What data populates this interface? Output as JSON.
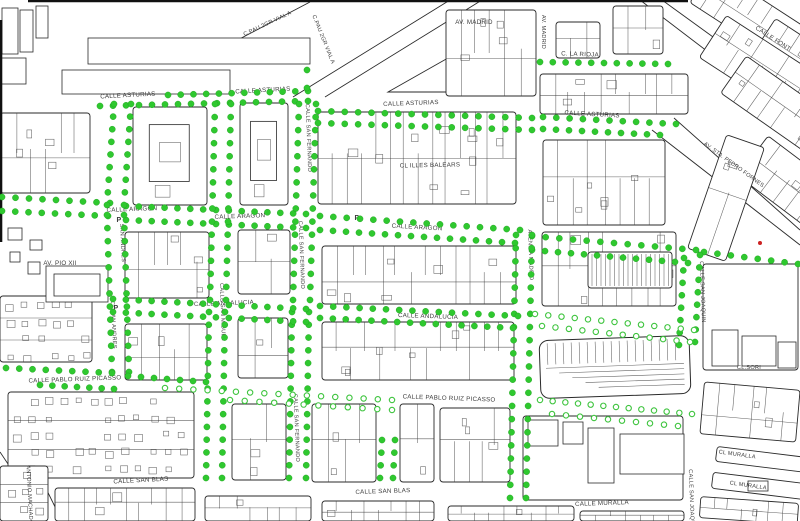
{
  "map": {
    "title": "cadastral street map with survey point markers",
    "canvas": {
      "w": 800,
      "h": 521
    },
    "colors": {
      "background": "#ffffff",
      "block_line": "#2a2a2a",
      "texture_line": "#3a3a3a",
      "label_text": "#3c3c3c",
      "dot_fill": "#2fc82f",
      "dot_edge": "#1a9e1a",
      "hollow_dot_stroke": "#3ec43e",
      "red_dot": "#cc2222",
      "border_line": "#111111"
    },
    "street_labels": [
      {
        "t": "CALLE ASTURIAS",
        "x": 128,
        "y": 97,
        "r": -3
      },
      {
        "t": "CALLE ASTURIAS",
        "x": 263,
        "y": 92,
        "r": -3
      },
      {
        "t": "CALLE ASTURIAS",
        "x": 411,
        "y": 105,
        "r": -2
      },
      {
        "t": "CALLE ASTURIAS",
        "x": 592,
        "y": 116,
        "r": 3
      },
      {
        "t": "C. LA RIOJA",
        "x": 580,
        "y": 56,
        "r": 2
      },
      {
        "t": "AV. MADRID",
        "x": 474,
        "y": 24,
        "r": 0
      },
      {
        "t": "AV. MADRID",
        "x": 542,
        "y": 32,
        "r": 90,
        "s": 5.6
      },
      {
        "t": "C.PAU 2GR VIAL A",
        "x": 268,
        "y": 25,
        "r": -25,
        "s": 5.6
      },
      {
        "t": "C.PAU 2GR VIAL A",
        "x": 322,
        "y": 40,
        "r": 68,
        "s": 5.6
      },
      {
        "t": "CALLE FONT",
        "x": 772,
        "y": 40,
        "r": 33
      },
      {
        "t": "CALLE ARAGON",
        "x": 132,
        "y": 211,
        "r": -2
      },
      {
        "t": "CALLE ARAGON",
        "x": 240,
        "y": 218,
        "r": -2
      },
      {
        "t": "CALLE ARAGON",
        "x": 417,
        "y": 229,
        "r": 3
      },
      {
        "t": "AV. PIO XII",
        "x": 60,
        "y": 265,
        "r": 0
      },
      {
        "t": "CL ILLES BALEARS",
        "x": 430,
        "y": 167,
        "r": -1
      },
      {
        "t": "CALLE ANDALUCIA",
        "x": 224,
        "y": 305,
        "r": -2
      },
      {
        "t": "CALLE ANDALUCIA",
        "x": 428,
        "y": 318,
        "r": 2
      },
      {
        "t": "CALLE PABLO RUIZ PICASSO",
        "x": 75,
        "y": 381,
        "r": -2
      },
      {
        "t": "CALLE PABLO RUIZ PICASSO",
        "x": 449,
        "y": 400,
        "r": 2
      },
      {
        "t": "CALLE SAN BLAS",
        "x": 141,
        "y": 482,
        "r": -3
      },
      {
        "t": "CALLE SAN BLAS",
        "x": 383,
        "y": 493,
        "r": -2
      },
      {
        "t": "CALLE MURALLA",
        "x": 602,
        "y": 505,
        "r": -2
      },
      {
        "t": "CL MURALLA",
        "x": 737,
        "y": 456,
        "r": 8,
        "s": 5.6
      },
      {
        "t": "CL MURALLA",
        "x": 748,
        "y": 487,
        "r": 8,
        "s": 5.6
      },
      {
        "t": "CL.SORI",
        "x": 749,
        "y": 369,
        "r": 0,
        "s": 5.6
      },
      {
        "t": "AV. STA. PEDRO FORNES",
        "x": 733,
        "y": 166,
        "r": 36,
        "s": 5.6
      },
      {
        "t": "SAN ANDRES",
        "x": 121,
        "y": 243,
        "r": 87,
        "s": 5.6
      },
      {
        "t": "CL SAN ANDRES",
        "x": 112,
        "y": 325,
        "r": 87,
        "s": 5.6
      },
      {
        "t": "CALLE SAN MIGUEL",
        "x": 221,
        "y": 312,
        "r": 88,
        "s": 5.6
      },
      {
        "t": "CALLE SAN FERNANDO",
        "x": 307,
        "y": 138,
        "r": 88,
        "s": 5.6
      },
      {
        "t": "CALLE SAN FERNANDO",
        "x": 300,
        "y": 255,
        "r": 88,
        "s": 5.6
      },
      {
        "t": "CALLE SAN FERNANDO",
        "x": 295,
        "y": 428,
        "r": 88,
        "s": 5.6
      },
      {
        "t": "AVENIDA MADRID",
        "x": 529,
        "y": 255,
        "r": 88,
        "s": 5.6
      },
      {
        "t": "CALLE SAN JOAQUIN",
        "x": 701,
        "y": 292,
        "r": 88,
        "s": 5.6
      },
      {
        "t": "CALLE SAN JOAQUIN",
        "x": 690,
        "y": 500,
        "r": 88,
        "s": 5.6
      },
      {
        "t": "ANTONIO MACHADO",
        "x": 28,
        "y": 495,
        "r": 87,
        "s": 5.6
      }
    ],
    "parking_marks": [
      [
        119,
        222
      ],
      [
        116,
        310
      ],
      [
        357,
        220
      ]
    ],
    "marker_legend": {
      "filled": "surveyed point",
      "hollow": "pending point"
    },
    "dot_chains": [
      [
        168,
        95,
        308,
        91,
        12
      ],
      [
        100,
        106,
        308,
        101,
        17
      ],
      [
        318,
        111,
        532,
        118,
        17
      ],
      [
        318,
        123,
        532,
        130,
        17
      ],
      [
        543,
        117,
        676,
        124,
        11
      ],
      [
        543,
        129,
        660,
        135,
        10
      ],
      [
        540,
        62,
        668,
        64,
        11
      ],
      [
        307,
        70,
        307,
        88,
        2
      ],
      [
        2,
        197,
        110,
        203,
        9
      ],
      [
        2,
        211,
        108,
        216,
        9
      ],
      [
        126,
        206,
        306,
        214,
        15
      ],
      [
        126,
        220,
        306,
        228,
        15
      ],
      [
        320,
        216,
        520,
        230,
        16
      ],
      [
        320,
        230,
        515,
        243,
        16
      ],
      [
        532,
        236,
        696,
        250,
        13
      ],
      [
        532,
        250,
        688,
        263,
        13
      ],
      [
        704,
        252,
        798,
        264,
        8
      ],
      [
        114,
        104,
        107,
        205,
        9
      ],
      [
        107,
        215,
        112,
        372,
        13
      ],
      [
        131,
        104,
        124,
        205,
        9
      ],
      [
        124,
        215,
        129,
        372,
        13
      ],
      [
        215,
        104,
        210,
        300,
        16
      ],
      [
        209,
        312,
        206,
        478,
        14
      ],
      [
        231,
        104,
        226,
        300,
        16
      ],
      [
        225,
        312,
        222,
        478,
        14
      ],
      [
        299,
        104,
        293,
        300,
        16
      ],
      [
        292,
        312,
        289,
        478,
        14
      ],
      [
        316,
        104,
        310,
        300,
        16
      ],
      [
        309,
        312,
        306,
        478,
        14
      ],
      [
        516,
        235,
        510,
        498,
        21
      ],
      [
        532,
        235,
        526,
        498,
        21
      ],
      [
        684,
        258,
        679,
        345,
        8
      ],
      [
        700,
        255,
        695,
        342,
        8
      ],
      [
        113,
        299,
        306,
        309,
        16
      ],
      [
        113,
        312,
        306,
        322,
        16
      ],
      [
        320,
        306,
        518,
        316,
        16
      ],
      [
        320,
        318,
        513,
        328,
        16
      ],
      [
        535,
        314,
        694,
        330,
        13,
        1
      ],
      [
        542,
        326,
        690,
        342,
        12,
        1
      ],
      [
        6,
        368,
        112,
        373,
        9
      ],
      [
        40,
        385,
        114,
        389,
        7
      ],
      [
        128,
        376,
        206,
        382,
        7
      ],
      [
        165,
        388,
        392,
        400,
        17,
        1
      ],
      [
        230,
        400,
        392,
        410,
        12,
        1
      ],
      [
        540,
        400,
        692,
        414,
        13,
        1
      ],
      [
        552,
        414,
        678,
        426,
        10,
        1
      ],
      [
        382,
        440,
        380,
        478,
        4
      ],
      [
        395,
        440,
        393,
        478,
        4
      ]
    ],
    "red_dots": [
      [
        760,
        243
      ]
    ],
    "blocks": [
      [
        "comb",
        446,
        10,
        90,
        86
      ],
      [
        "comb",
        556,
        22,
        44,
        36
      ],
      [
        "comb",
        613,
        6,
        50,
        48
      ],
      [
        "comb",
        540,
        74,
        148,
        40
      ],
      [
        "comb",
        0,
        113,
        90,
        80
      ],
      [
        "courtyard",
        133,
        107,
        74,
        98
      ],
      [
        "courtyard",
        240,
        103,
        48,
        102
      ],
      [
        "comb",
        318,
        112,
        198,
        92
      ],
      [
        "comb",
        543,
        140,
        122,
        85
      ],
      [
        "comb",
        125,
        232,
        84,
        66
      ],
      [
        "comb",
        238,
        230,
        52,
        64
      ],
      [
        "comb",
        322,
        246,
        194,
        58
      ],
      [
        "comb",
        542,
        232,
        134,
        74
      ],
      [
        "stripes",
        588,
        252,
        84,
        36
      ],
      [
        "dense",
        0,
        296,
        92,
        66
      ],
      [
        "comb",
        125,
        324,
        82,
        56
      ],
      [
        "comb",
        238,
        318,
        50,
        60
      ],
      [
        "comb",
        322,
        322,
        192,
        58
      ],
      [
        "bars",
        540,
        338,
        150,
        58,
        -2
      ],
      [
        "plain",
        703,
        264,
        95,
        106
      ],
      [
        "dense",
        8,
        392,
        186,
        86
      ],
      [
        "comb",
        232,
        404,
        54,
        76
      ],
      [
        "comb",
        312,
        404,
        64,
        78
      ],
      [
        "comb",
        400,
        404,
        34,
        78
      ],
      [
        "comb",
        440,
        408,
        70,
        74
      ],
      [
        "plain",
        523,
        416,
        160,
        84
      ],
      [
        "dense",
        0,
        466,
        48,
        55
      ],
      [
        "comb",
        55,
        488,
        140,
        33
      ],
      [
        "comb",
        205,
        496,
        106,
        25
      ],
      [
        "comb",
        322,
        501,
        112,
        20
      ],
      [
        "comb",
        448,
        506,
        126,
        15
      ],
      [
        "comb",
        580,
        511,
        104,
        10
      ],
      [
        "comb",
        702,
        386,
        96,
        52,
        5
      ],
      [
        "comb",
        700,
        500,
        98,
        21,
        4
      ],
      [
        "comb",
        690,
        2,
        140,
        42,
        33
      ],
      [
        "comb",
        755,
        48,
        120,
        40,
        33
      ],
      [
        "comb",
        700,
        55,
        160,
        50,
        33
      ],
      [
        "comb",
        720,
        95,
        150,
        45,
        35
      ],
      [
        "comb",
        740,
        170,
        130,
        50,
        37
      ],
      [
        "comb",
        706,
        138,
        40,
        120,
        19
      ],
      [
        "plain",
        716,
        452,
        92,
        15,
        7
      ],
      [
        "plain",
        712,
        478,
        95,
        16,
        7
      ]
    ],
    "buildings": [
      [
        88,
        38,
        222,
        26
      ],
      [
        62,
        70,
        168,
        24
      ],
      [
        2,
        8,
        16,
        46
      ],
      [
        20,
        10,
        13,
        42
      ],
      [
        36,
        6,
        12,
        32
      ],
      [
        0,
        58,
        26,
        26
      ],
      [
        46,
        266,
        62,
        36
      ],
      [
        54,
        274,
        46,
        22
      ],
      [
        8,
        228,
        14,
        12
      ],
      [
        30,
        240,
        12,
        10
      ],
      [
        10,
        252,
        10,
        10
      ],
      [
        28,
        262,
        12,
        12
      ],
      [
        712,
        330,
        26,
        36
      ],
      [
        742,
        336,
        34,
        30
      ],
      [
        778,
        342,
        18,
        26
      ],
      [
        528,
        420,
        30,
        26
      ],
      [
        563,
        422,
        20,
        22
      ],
      [
        588,
        428,
        26,
        55
      ],
      [
        620,
        434,
        64,
        40
      ],
      [
        748,
        481,
        20,
        10
      ]
    ],
    "diag_lines": [
      [
        293,
        97,
        450,
        0
      ],
      [
        325,
        97,
        482,
        0
      ],
      [
        228,
        45,
        310,
        2
      ],
      [
        640,
        0,
        800,
        122
      ],
      [
        662,
        0,
        800,
        100
      ],
      [
        652,
        130,
        800,
        245
      ],
      [
        674,
        118,
        800,
        230
      ],
      [
        0,
        452,
        46,
        521
      ],
      [
        26,
        448,
        62,
        521
      ]
    ],
    "triangles": [
      [
        [
          388,
          92
        ],
        [
          448,
          58
        ],
        [
          448,
          92
        ]
      ]
    ],
    "border_lines": [
      [
        28,
        1,
        688,
        1
      ],
      [
        1,
        20,
        1,
        242
      ]
    ]
  }
}
